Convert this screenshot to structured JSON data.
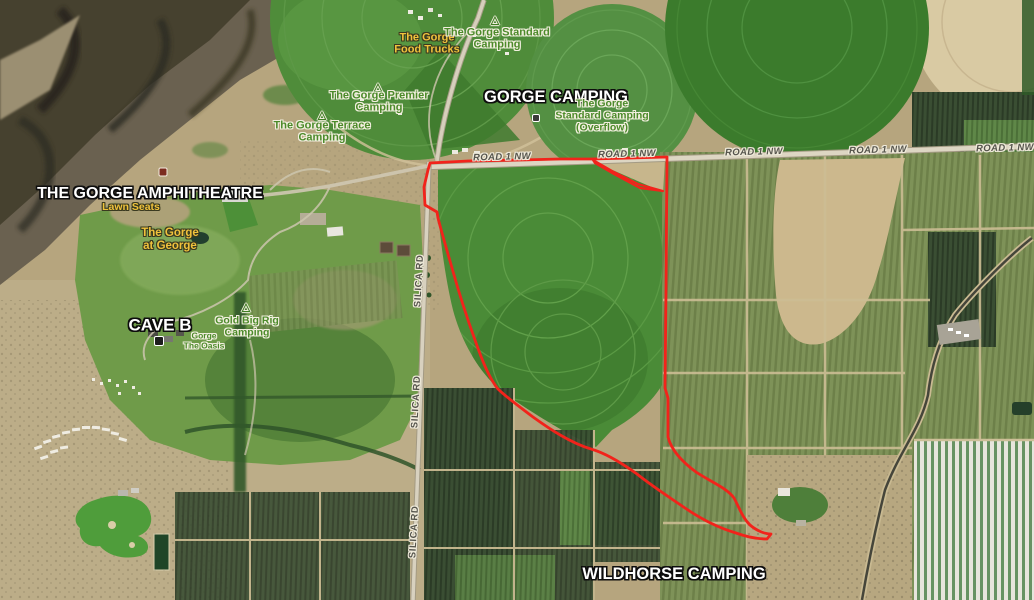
{
  "map": {
    "description": "Satellite basemap of The Gorge Amphitheatre area, George WA, with campgrounds and a red outlined parcel",
    "boundary_color": "#f2231b"
  },
  "places": {
    "amphitheatre": {
      "label": "THE GORGE AMPHITHEATRE"
    },
    "lawn_seats": {
      "label": "Lawn Seats"
    },
    "gorge_at_george": {
      "lines": [
        "The Gorge",
        "at George"
      ]
    },
    "cave_b": {
      "label": "CAVE B"
    },
    "oasis": {
      "lines": [
        "Gorge",
        "The Oasis"
      ]
    },
    "gold_big_rig": {
      "lines": [
        "Gold Big Rig",
        "Camping"
      ]
    },
    "gorge_camping": {
      "label": "GORGE CAMPING"
    },
    "food_trucks": {
      "lines": [
        "The Gorge",
        "Food Trucks"
      ]
    },
    "standard_camping": {
      "lines": [
        "The Gorge Standard",
        "Camping"
      ]
    },
    "standard_camping_overflow": {
      "lines": [
        "The Gorge",
        "Standard Camping",
        "(Overflow)"
      ]
    },
    "premier_camping": {
      "lines": [
        "The Gorge Premier",
        "Camping"
      ]
    },
    "terrace_camping": {
      "lines": [
        "The Gorge Terrace",
        "Camping"
      ]
    },
    "wildhorse_camping": {
      "label": "WILDHORSE CAMPING"
    }
  },
  "roads": {
    "road1nw": "ROAD 1 NW",
    "silica": "SILICA RD"
  },
  "icons": {
    "campground_glyph": "△"
  },
  "colors": {
    "boundary_red": "#f2231b",
    "label_white": "#ffffff",
    "label_yellow": "#f0c23c",
    "label_green": "#4c8a2a",
    "road_label_gray": "#55544c"
  }
}
